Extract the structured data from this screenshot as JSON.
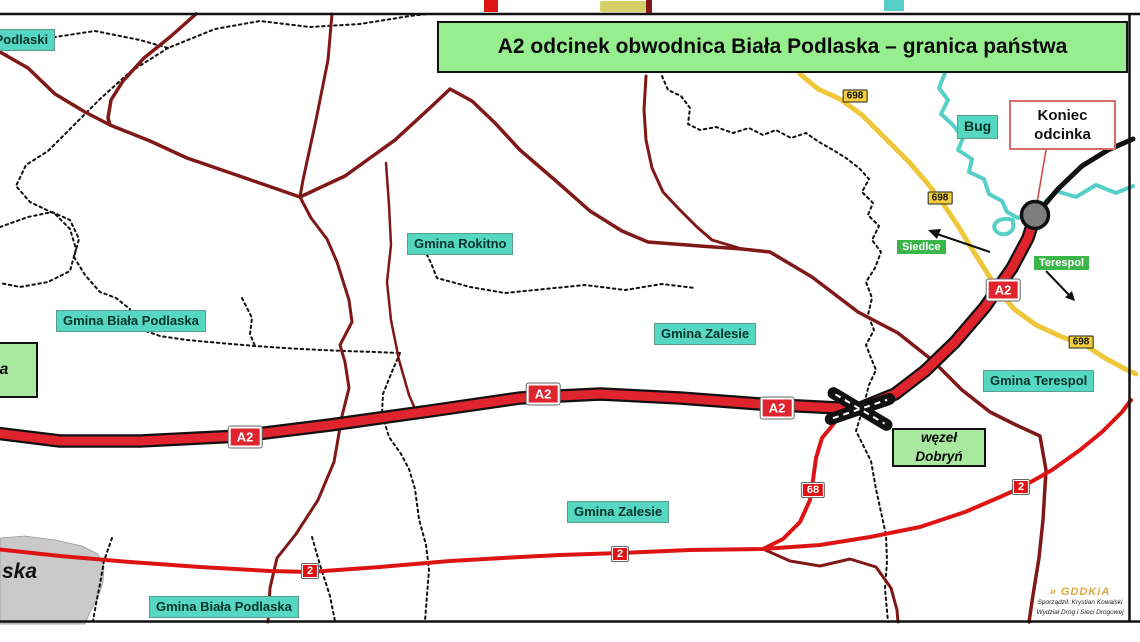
{
  "title": "A2 odcinek obwodnica Biała Podlaska – granica państwa",
  "labels": {
    "gmina_janow_fragment": "nów Podlaski",
    "gmina_biala_podlaska": "Gmina Biała Podlaska",
    "gmina_rokitno": "Gmina Rokitno",
    "gmina_zalesie": "Gmina Zalesie",
    "gmina_terespol": "Gmina Terespol",
    "bug_river": "Bug",
    "siedlce_direction": "Siedlce",
    "terespol_direction": "Terespol",
    "wezel_line1": "węzeł",
    "wezel_line2": "Dobryń",
    "koniec_line1": "Koniec",
    "koniec_line2": "odcinka",
    "left_box_fragment": "a",
    "city_fragment": "ska"
  },
  "shields": {
    "a2": "A2",
    "dk2": "2",
    "dk68": "68",
    "dw698": "698"
  },
  "credits": {
    "logo": "GDDKiA",
    "logo_mark": "»",
    "line1": "Sporządził: Krystian Kowalski",
    "line2": "Wydział Dróg i Sieci Drogowej"
  },
  "colors": {
    "motorway_red": "#e0242e",
    "national_road_red": "#de1414",
    "local_road_maroon": "#801818",
    "regional_road_yellow": "#eec83a",
    "river_teal": "#55cfc7",
    "label_cyan": "#55d7c2",
    "title_green": "#97ee8f",
    "direction_green": "#3cb54a",
    "city_area_gray": "#c9c9c9"
  }
}
